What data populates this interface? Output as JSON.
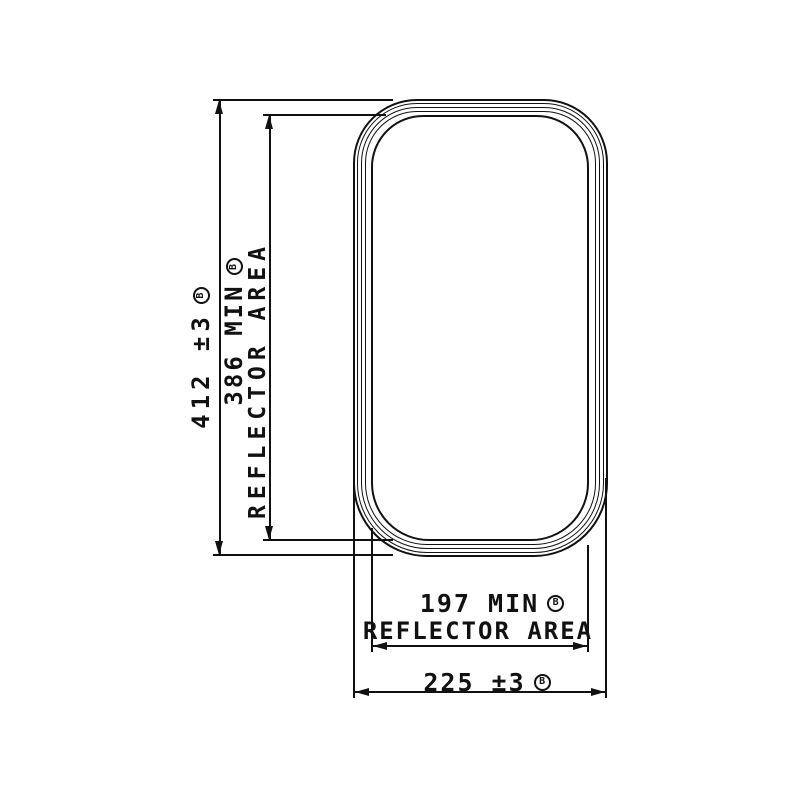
{
  "drawing": {
    "kind": "mirror-technical-drawing",
    "colors": {
      "line": "#111111",
      "background": "#ffffff"
    },
    "note_symbol": "B",
    "dimensions": {
      "height_overall": {
        "value": "412 ±3"
      },
      "height_reflector": {
        "value": "386 MIN",
        "area": "REFLECTOR AREA"
      },
      "width_reflector": {
        "value": "197 MIN",
        "area": "REFLECTOR AREA"
      },
      "width_overall": {
        "value": "225 ±3"
      }
    }
  }
}
